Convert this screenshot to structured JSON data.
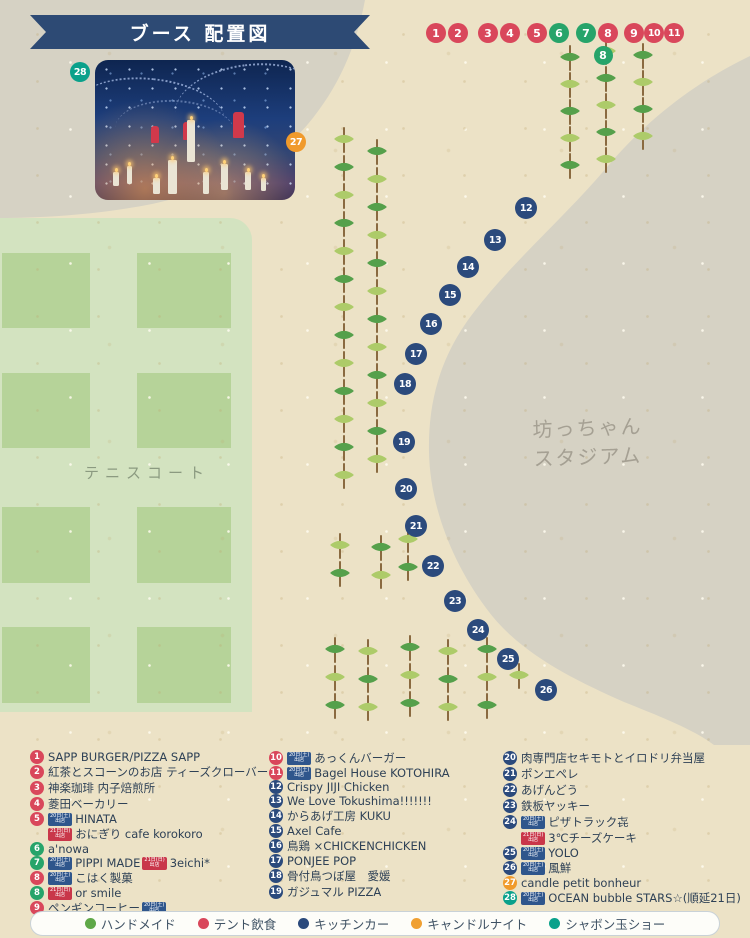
{
  "banner": {
    "title": "ブース 配置図"
  },
  "map": {
    "tennis_court_label": "テニスコート",
    "stadium_label_1": "坊っちゃん",
    "stadium_label_2": "スタジアム",
    "markers": [
      {
        "n": "1",
        "x": 436,
        "y": 33,
        "d": 20,
        "c": "tent"
      },
      {
        "n": "2",
        "x": 458,
        "y": 33,
        "d": 20,
        "c": "tent"
      },
      {
        "n": "3",
        "x": 488,
        "y": 33,
        "d": 20,
        "c": "tent"
      },
      {
        "n": "4",
        "x": 510,
        "y": 33,
        "d": 20,
        "c": "tent"
      },
      {
        "n": "5",
        "x": 537,
        "y": 33,
        "d": 20,
        "c": "tent"
      },
      {
        "n": "6",
        "x": 559,
        "y": 33,
        "d": 20,
        "c": "hand"
      },
      {
        "n": "7",
        "x": 586,
        "y": 33,
        "d": 20,
        "c": "hand"
      },
      {
        "n": "8",
        "x": 608,
        "y": 33,
        "d": 20,
        "c": "tent"
      },
      {
        "n": "9",
        "x": 634,
        "y": 33,
        "d": 20,
        "c": "tent"
      },
      {
        "n": "10",
        "x": 654,
        "y": 33,
        "d": 20,
        "c": "tent"
      },
      {
        "n": "11",
        "x": 674,
        "y": 33,
        "d": 20,
        "c": "tent"
      },
      {
        "n": "8",
        "x": 603,
        "y": 55,
        "d": 19,
        "c": "hand"
      },
      {
        "n": "28",
        "x": 80,
        "y": 72,
        "d": 20,
        "c": "bubble"
      },
      {
        "n": "27",
        "x": 296,
        "y": 142,
        "d": 20,
        "c": "candle"
      },
      {
        "n": "12",
        "x": 526,
        "y": 208,
        "d": 22,
        "c": "kitchen"
      },
      {
        "n": "13",
        "x": 495,
        "y": 240,
        "d": 22,
        "c": "kitchen"
      },
      {
        "n": "14",
        "x": 468,
        "y": 267,
        "d": 22,
        "c": "kitchen"
      },
      {
        "n": "15",
        "x": 450,
        "y": 295,
        "d": 22,
        "c": "kitchen"
      },
      {
        "n": "16",
        "x": 431,
        "y": 324,
        "d": 22,
        "c": "kitchen"
      },
      {
        "n": "17",
        "x": 416,
        "y": 354,
        "d": 22,
        "c": "kitchen"
      },
      {
        "n": "18",
        "x": 405,
        "y": 384,
        "d": 22,
        "c": "kitchen"
      },
      {
        "n": "19",
        "x": 404,
        "y": 442,
        "d": 22,
        "c": "kitchen"
      },
      {
        "n": "20",
        "x": 406,
        "y": 489,
        "d": 22,
        "c": "kitchen"
      },
      {
        "n": "21",
        "x": 416,
        "y": 526,
        "d": 22,
        "c": "kitchen"
      },
      {
        "n": "22",
        "x": 433,
        "y": 566,
        "d": 22,
        "c": "kitchen"
      },
      {
        "n": "23",
        "x": 455,
        "y": 601,
        "d": 22,
        "c": "kitchen"
      },
      {
        "n": "24",
        "x": 478,
        "y": 630,
        "d": 22,
        "c": "kitchen"
      },
      {
        "n": "25",
        "x": 508,
        "y": 659,
        "d": 22,
        "c": "kitchen"
      },
      {
        "n": "26",
        "x": 546,
        "y": 690,
        "d": 22,
        "c": "kitchen"
      }
    ],
    "tree_columns": [
      {
        "x": 570,
        "y": 58,
        "count": 5,
        "step": 27
      },
      {
        "x": 606,
        "y": 52,
        "count": 5,
        "step": 27
      },
      {
        "x": 643,
        "y": 56,
        "count": 4,
        "step": 27
      },
      {
        "x": 344,
        "y": 140,
        "count": 13,
        "step": 28
      },
      {
        "x": 377,
        "y": 152,
        "count": 12,
        "step": 28
      },
      {
        "x": 340,
        "y": 546,
        "count": 2,
        "step": 28
      },
      {
        "x": 381,
        "y": 548,
        "count": 2,
        "step": 28
      },
      {
        "x": 408,
        "y": 540,
        "count": 2,
        "step": 28
      },
      {
        "x": 335,
        "y": 650,
        "count": 3,
        "step": 28
      },
      {
        "x": 368,
        "y": 652,
        "count": 3,
        "step": 28
      },
      {
        "x": 410,
        "y": 648,
        "count": 3,
        "step": 28
      },
      {
        "x": 448,
        "y": 652,
        "count": 3,
        "step": 28
      },
      {
        "x": 487,
        "y": 650,
        "count": 3,
        "step": 28
      },
      {
        "x": 519,
        "y": 676,
        "count": 1,
        "step": 28
      }
    ]
  },
  "colors": {
    "tent": "#d9475b",
    "hand": "#27a46a",
    "kitchen": "#2b4a7c",
    "candle": "#f09a2b",
    "bubble": "#0aa18b"
  },
  "badges": {
    "sat": {
      "lines": [
        "20日(土)",
        "出店"
      ],
      "color": "#2f568c"
    },
    "sun": {
      "lines": [
        "21日(日)",
        "出店"
      ],
      "color": "#c9374a"
    }
  },
  "booths": {
    "columns": [
      {
        "left": 30,
        "rows": [
          {
            "n": "1",
            "c": "tent",
            "seg": [
              {
                "t": "x",
                "v": "SAPP BURGER/PIZZA SAPP"
              }
            ]
          },
          {
            "n": "2",
            "c": "tent",
            "seg": [
              {
                "t": "x",
                "v": "紅茶とスコーンのお店 ティーズクローバー"
              }
            ]
          },
          {
            "n": "3",
            "c": "tent",
            "seg": [
              {
                "t": "x",
                "v": "神楽珈琲 内子焙煎所"
              }
            ]
          },
          {
            "n": "4",
            "c": "tent",
            "seg": [
              {
                "t": "x",
                "v": "菱田ベーカリー"
              }
            ]
          },
          {
            "n": "5",
            "c": "tent",
            "seg": [
              {
                "t": "b",
                "v": "sat"
              },
              {
                "t": "x",
                "v": "HINATA"
              }
            ]
          },
          {
            "n": null,
            "seg": [
              {
                "t": "b",
                "v": "sun"
              },
              {
                "t": "x",
                "v": "おにぎり cafe korokoro"
              }
            ]
          },
          {
            "n": "6",
            "c": "hand",
            "seg": [
              {
                "t": "x",
                "v": "a'nowa"
              }
            ]
          },
          {
            "n": "7",
            "c": "hand",
            "seg": [
              {
                "t": "b",
                "v": "sat"
              },
              {
                "t": "x",
                "v": "PIPPI MADE "
              },
              {
                "t": "b",
                "v": "sun"
              },
              {
                "t": "x",
                "v": "3eichi*"
              }
            ]
          },
          {
            "n": "8",
            "c": "tent",
            "seg": [
              {
                "t": "b",
                "v": "sat"
              },
              {
                "t": "x",
                "v": "こはく製菓"
              }
            ]
          },
          {
            "n": "8",
            "c": "hand",
            "seg": [
              {
                "t": "b",
                "v": "sun"
              },
              {
                "t": "x",
                "v": "or smile"
              }
            ]
          },
          {
            "n": "9",
            "c": "tent",
            "seg": [
              {
                "t": "x",
                "v": "ペンギンコーヒー"
              },
              {
                "t": "b",
                "v": "sat"
              }
            ]
          }
        ]
      },
      {
        "left": 269,
        "rows": [
          {
            "n": "10",
            "c": "tent",
            "seg": [
              {
                "t": "b",
                "v": "sat"
              },
              {
                "t": "x",
                "v": "あっくんバーガー"
              }
            ]
          },
          {
            "n": "11",
            "c": "tent",
            "seg": [
              {
                "t": "b",
                "v": "sat"
              },
              {
                "t": "x",
                "v": "Bagel House KOTOHIRA"
              }
            ]
          },
          {
            "n": "12",
            "c": "kitchen",
            "seg": [
              {
                "t": "x",
                "v": "Crispy JIJI Chicken"
              }
            ]
          },
          {
            "n": "13",
            "c": "kitchen",
            "seg": [
              {
                "t": "x",
                "v": "We Love Tokushima!!!!!!!"
              }
            ]
          },
          {
            "n": "14",
            "c": "kitchen",
            "seg": [
              {
                "t": "x",
                "v": "からあげ工房 KUKU"
              }
            ]
          },
          {
            "n": "15",
            "c": "kitchen",
            "seg": [
              {
                "t": "x",
                "v": "Axel Cafe"
              }
            ]
          },
          {
            "n": "16",
            "c": "kitchen",
            "seg": [
              {
                "t": "x",
                "v": "鳥鶏 ×CHICKENCHICKEN"
              }
            ]
          },
          {
            "n": "17",
            "c": "kitchen",
            "seg": [
              {
                "t": "x",
                "v": "PONJEE POP"
              }
            ]
          },
          {
            "n": "18",
            "c": "kitchen",
            "seg": [
              {
                "t": "x",
                "v": "骨付鳥つぼ屋　愛媛"
              }
            ]
          },
          {
            "n": "19",
            "c": "kitchen",
            "seg": [
              {
                "t": "x",
                "v": "ガジュマル PIZZA"
              }
            ]
          }
        ]
      },
      {
        "left": 503,
        "rows": [
          {
            "n": "20",
            "c": "kitchen",
            "seg": [
              {
                "t": "x",
                "v": "肉専門店セキモトとイロドリ弁当屋"
              }
            ]
          },
          {
            "n": "21",
            "c": "kitchen",
            "seg": [
              {
                "t": "x",
                "v": "ポンエペレ"
              }
            ]
          },
          {
            "n": "22",
            "c": "kitchen",
            "seg": [
              {
                "t": "x",
                "v": "あげんどう"
              }
            ]
          },
          {
            "n": "23",
            "c": "kitchen",
            "seg": [
              {
                "t": "x",
                "v": "鉄板ヤッキー"
              }
            ]
          },
          {
            "n": "24",
            "c": "kitchen",
            "seg": [
              {
                "t": "b",
                "v": "sat"
              },
              {
                "t": "x",
                "v": "ピザトラック㐂"
              }
            ]
          },
          {
            "n": null,
            "seg": [
              {
                "t": "b",
                "v": "sun"
              },
              {
                "t": "x",
                "v": "3℃チーズケーキ"
              }
            ]
          },
          {
            "n": "25",
            "c": "kitchen",
            "seg": [
              {
                "t": "b",
                "v": "sat"
              },
              {
                "t": "x",
                "v": "YOLO"
              }
            ]
          },
          {
            "n": "26",
            "c": "kitchen",
            "seg": [
              {
                "t": "b",
                "v": "sat"
              },
              {
                "t": "x",
                "v": "風鮮"
              }
            ]
          },
          {
            "n": "27",
            "c": "candle",
            "seg": [
              {
                "t": "x",
                "v": "candle petit bonheur"
              }
            ]
          },
          {
            "n": "28",
            "c": "bubble",
            "seg": [
              {
                "t": "b",
                "v": "sat"
              },
              {
                "t": "x",
                "v": "OCEAN bubble STARS☆(順延21日)"
              }
            ]
          }
        ]
      }
    ]
  },
  "legend": {
    "items": [
      {
        "label": "ハンドメイド",
        "color": "#5fa848"
      },
      {
        "label": "テント飲食",
        "color": "#d9475b"
      },
      {
        "label": "キッチンカー",
        "color": "#2b4a7c"
      },
      {
        "label": "キャンドルナイト",
        "color": "#f0a032"
      },
      {
        "label": "シャボン玉ショー",
        "color": "#0aa18b"
      }
    ]
  }
}
